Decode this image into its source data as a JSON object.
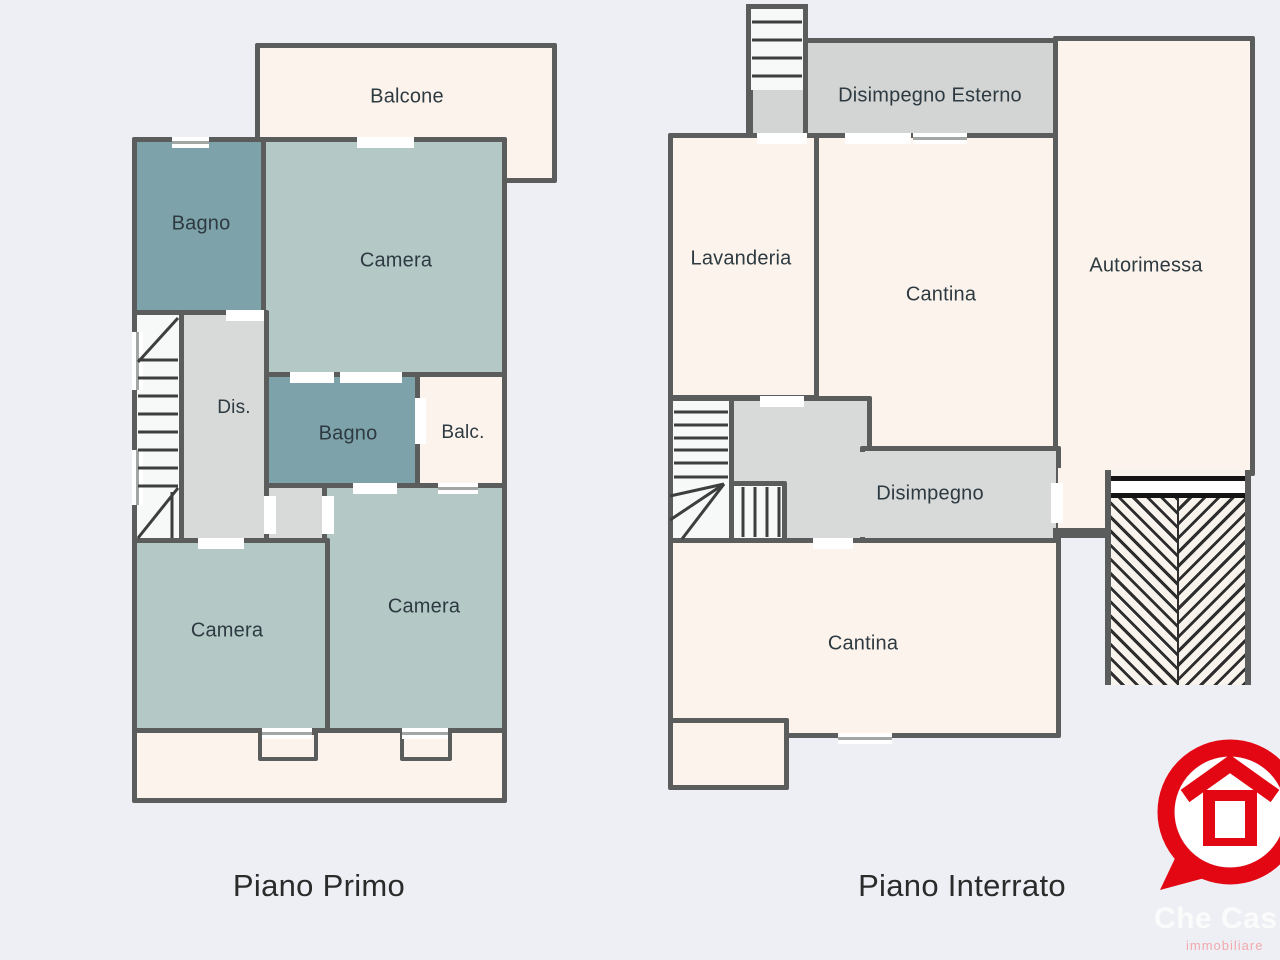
{
  "canvas": {
    "background": "#edeff4",
    "wall_color": "#5a5d5c"
  },
  "colors": {
    "room_cream": "#fcf4ec",
    "room_sage": "#b4c8c6",
    "room_teal": "#7da2a9",
    "corridor_gray": "#d8dad9",
    "exterior_gray": "#d3d5d4",
    "accent_red": "#e30613",
    "label_text": "#2e3a41",
    "title_text": "#2b2b2b"
  },
  "plans": [
    {
      "title": "Piano Primo",
      "rooms": {
        "balcone": {
          "label": "Balcone"
        },
        "bagno_top": {
          "label": "Bagno"
        },
        "camera_top": {
          "label": "Camera"
        },
        "dis": {
          "label": "Dis."
        },
        "bagno_mid": {
          "label": "Bagno"
        },
        "balc": {
          "label": "Balc."
        },
        "camera_se": {
          "label": "Camera"
        },
        "camera_sw": {
          "label": "Camera"
        }
      }
    },
    {
      "title": "Piano Interrato",
      "rooms": {
        "disimpegno_esterno": {
          "label": "Disimpegno Esterno"
        },
        "lavanderia": {
          "label": "Lavanderia"
        },
        "cantina_top": {
          "label": "Cantina"
        },
        "autorimessa": {
          "label": "Autorimessa"
        },
        "disimpegno": {
          "label": "Disimpegno"
        },
        "cantina_bottom": {
          "label": "Cantina"
        }
      }
    }
  ],
  "logo": {
    "brand": "Che Cas",
    "tagline": "immobiliare",
    "color": "#e30613"
  }
}
